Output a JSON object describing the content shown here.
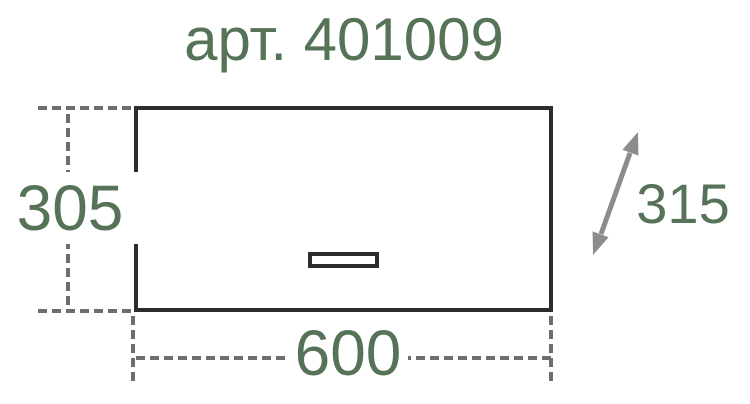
{
  "title": "арт. 401009",
  "dimensions": {
    "height_mm": "305",
    "width_mm": "600",
    "depth_mm": "315"
  },
  "colors": {
    "accent_green": "#567257",
    "line_dark": "#2d2d2d",
    "dash_gray": "#6e6e6e",
    "arrow_gray": "#8c8c8c",
    "bg": "#ffffff"
  }
}
